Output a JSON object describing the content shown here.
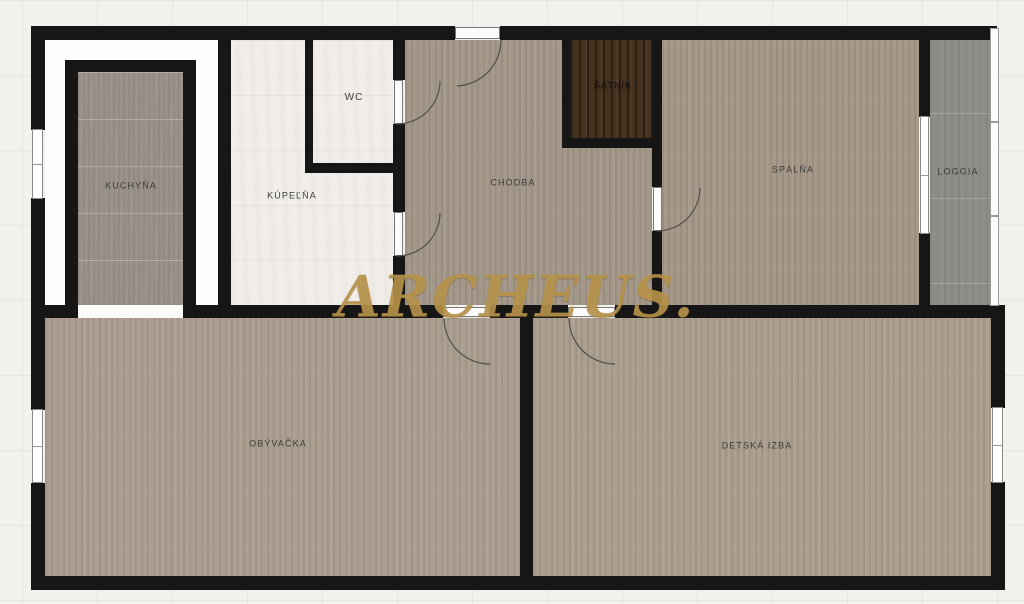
{
  "floorplan": {
    "watermark": "ARCHEUS.",
    "rooms": {
      "kuchyna": {
        "label": "KUCHYŇA"
      },
      "kupelna": {
        "label": "KÚPEĽŇA"
      },
      "wc": {
        "label": "WC"
      },
      "chodba": {
        "label": "CHODBA"
      },
      "satnik": {
        "label": "ŠATNÍK"
      },
      "spalna": {
        "label": "SPÁLŇA"
      },
      "loggia": {
        "label": "LOGGIA"
      },
      "obyvacka": {
        "label": "OBÝVAČKA"
      },
      "detska": {
        "label": "DETSKÁ IZBA"
      }
    },
    "colors": {
      "watermark_gold": "#b5914a",
      "wall_black": "#161616",
      "wood_floor": "#a79b8c",
      "kitchen_tile": "#9c938b",
      "bath_tile": "#f1eee9",
      "closet_wood": "#46321f",
      "loggia_concrete": "#8d8e88"
    }
  }
}
